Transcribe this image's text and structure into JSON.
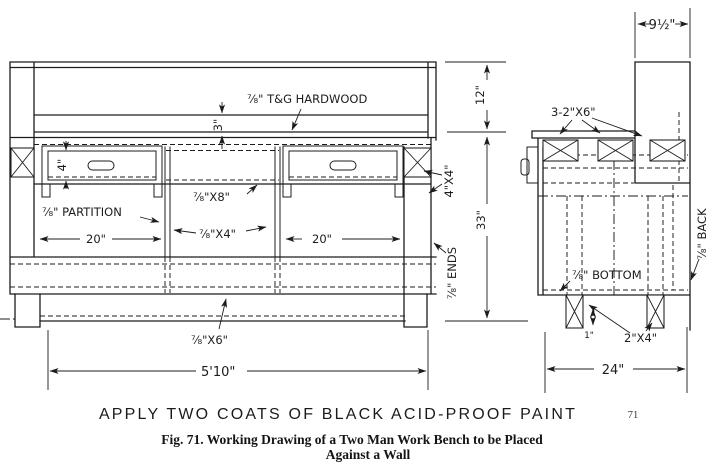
{
  "figure": {
    "paint_note": "APPLY TWO COATS OF BLACK ACID-PROOF PAINT",
    "page_number": "71",
    "caption_line1": "Fig. 71.  Working Drawing of a Two Man Work Bench to be Placed",
    "caption_line2": "Against a Wall"
  },
  "front_view": {
    "labels": {
      "top_material": "⅞\" T&G HARDWOOD",
      "apron_height": "3\"",
      "drawer_height": "4\"",
      "partition": "⅞\" PARTITION",
      "rail_8": "⅞\"X8\"",
      "rail_4": "⅞\"X4\"",
      "bay_left_width": "20\"",
      "bay_right_width": "20\"",
      "leg_size": "4\"X4\"",
      "back_height": "12\"",
      "bench_height": "33\"",
      "ends": "⅞\" ENDS",
      "bottom_rail": "⅞\"X6\"",
      "overall_width": "5'10\""
    }
  },
  "side_view": {
    "labels": {
      "top_depth": "9½\"",
      "top_frame": "3-2\"X6\"",
      "bottom_panel": "⅞\" BOTTOM",
      "back_panel": "⅞\" BACK",
      "leg_size": "2\"X4\"",
      "foot_offset": "1\"",
      "overall_depth": "24\""
    }
  }
}
